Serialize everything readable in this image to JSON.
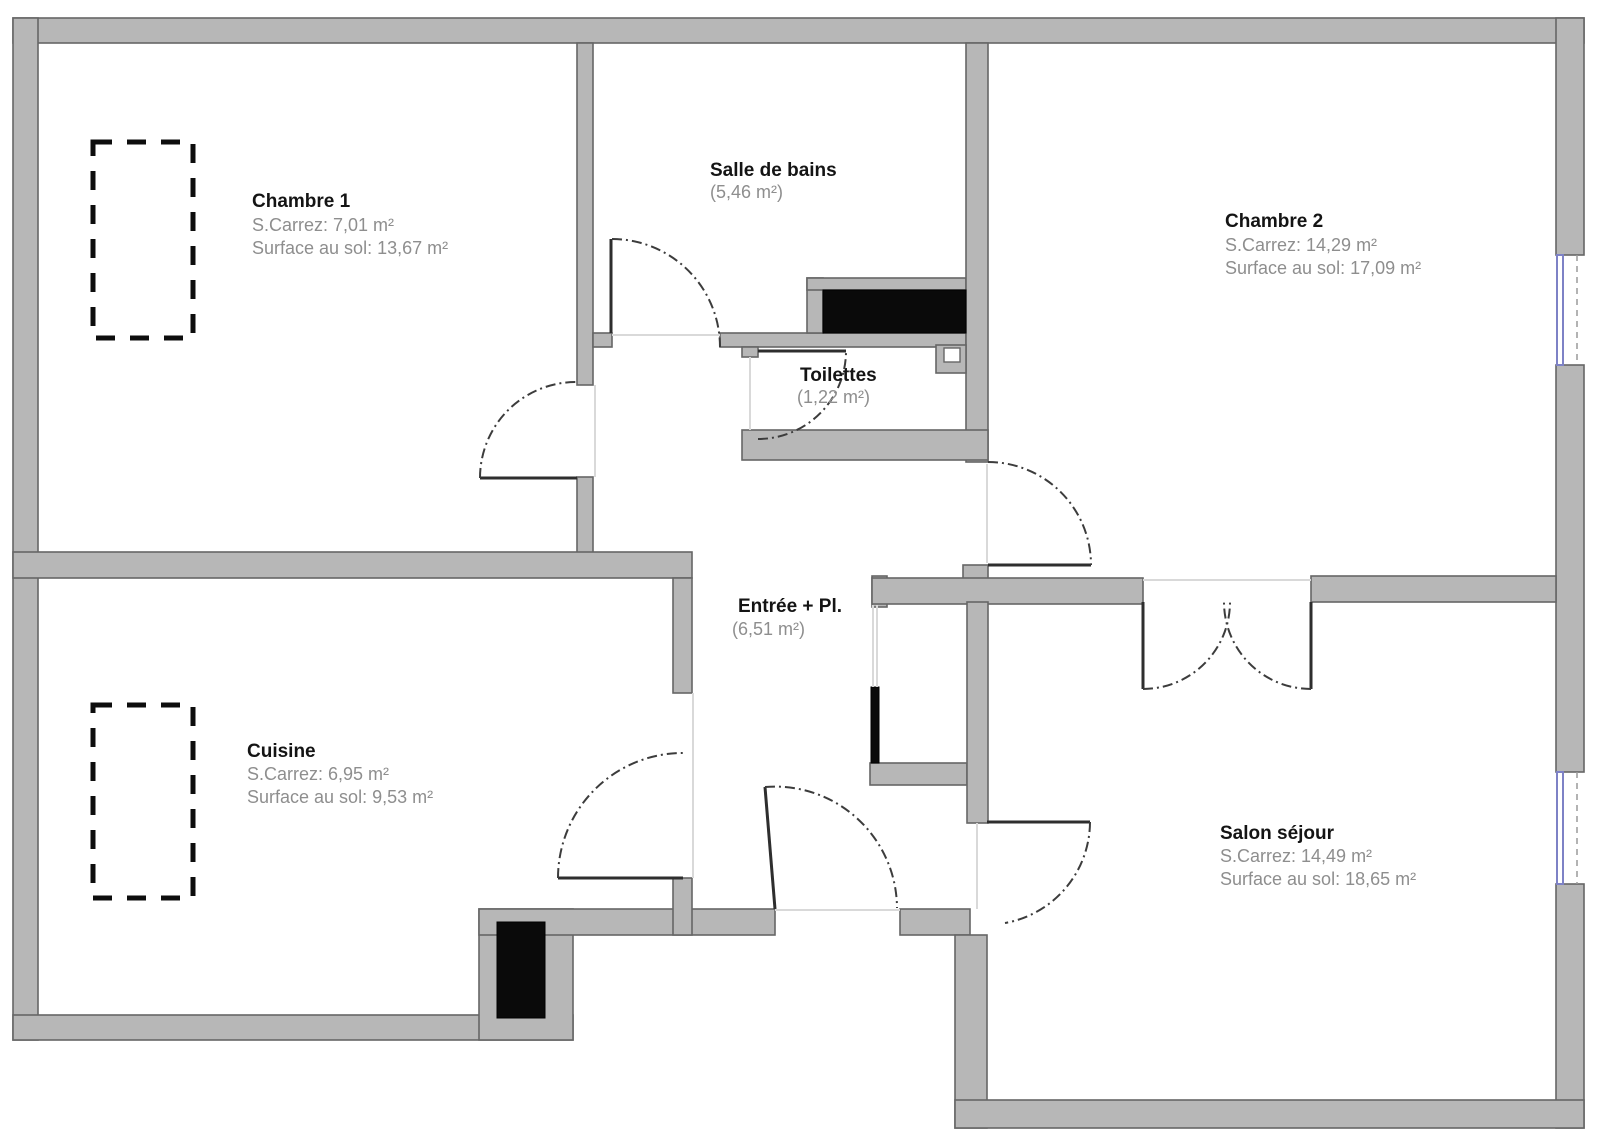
{
  "rooms": {
    "chambre1": {
      "name": "Chambre 1",
      "carrez": "S.Carrez: 7,01 m²",
      "floor": "Surface au sol: 13,67 m²"
    },
    "salle_de_bains": {
      "name": "Salle de bains",
      "area": "(5,46 m²)"
    },
    "toilettes": {
      "name": "Toilettes",
      "area": "(1,22 m²)"
    },
    "chambre2": {
      "name": "Chambre 2",
      "carrez": "S.Carrez: 14,29 m²",
      "floor": "Surface au sol: 17,09 m²"
    },
    "entree": {
      "name": "Entrée + Pl.",
      "area": "(6,51 m²)"
    },
    "cuisine": {
      "name": "Cuisine",
      "carrez": "S.Carrez: 6,95 m²",
      "floor": "Surface au sol: 9,53 m²"
    },
    "salon": {
      "name": "Salon séjour",
      "carrez": "S.Carrez: 14,49 m²",
      "floor": "Surface au sol: 18,65 m²"
    }
  },
  "colors": {
    "wall_fill": "#b7b7b7",
    "wall_stroke": "#666666",
    "fixture_black": "#0a0a0a",
    "window_accent": "#7e82c6",
    "title_text": "#141414",
    "sub_text": "#8e8e8e",
    "door_arc": "#3c3c3c",
    "threshold": "#d9d9d9"
  }
}
